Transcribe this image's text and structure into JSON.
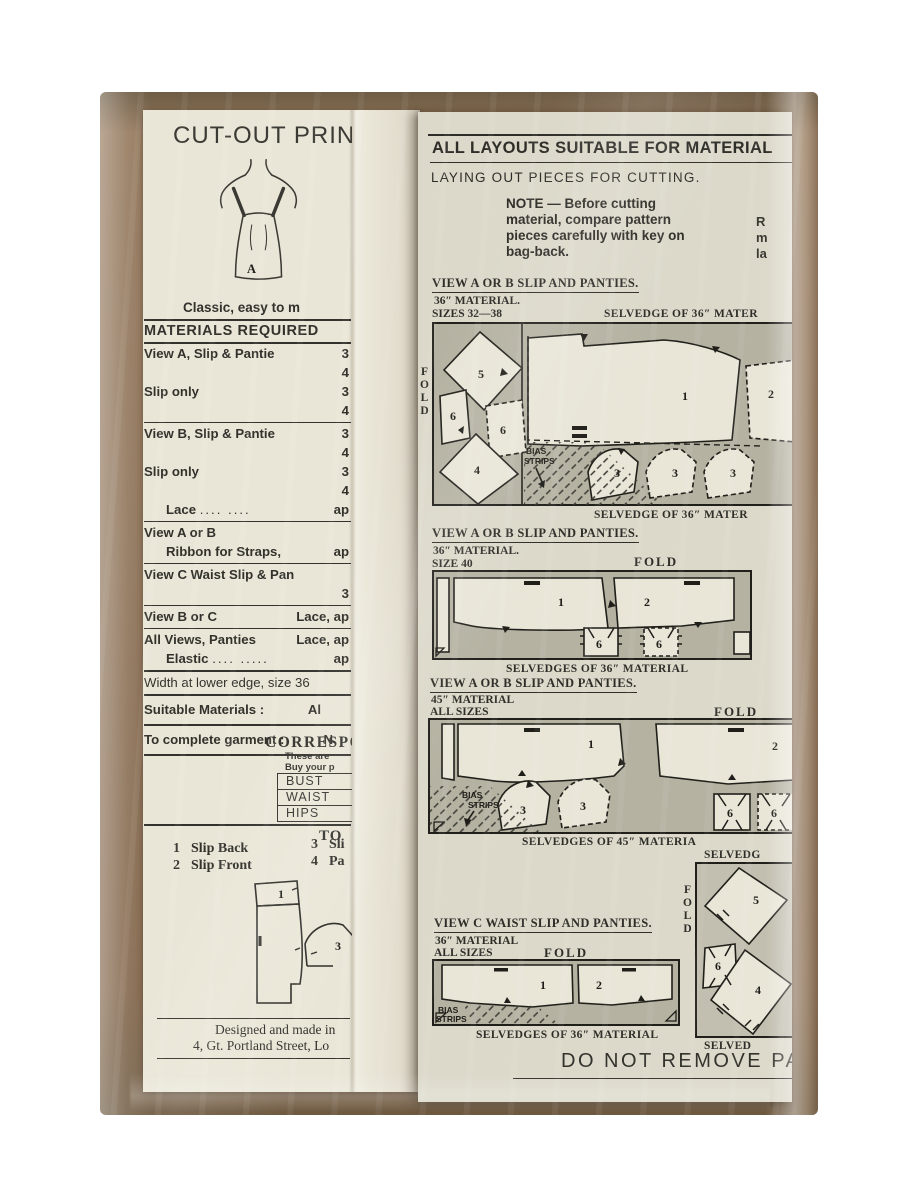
{
  "photo": {
    "background": "#ffffff",
    "kraft_brown": "#8d7257",
    "left_paper": "#eae6d7",
    "right_paper": "#dcd9ca",
    "ink": "#32312c",
    "fabric_gray": "#b5b2a2"
  },
  "left_page": {
    "title": "CUT-OUT PRINTED",
    "figure_label": "A",
    "tagline": "Classic, easy to m",
    "materials": {
      "heading": "MATERIALS REQUIRED",
      "row1": {
        "label": "View A, Slip & Pantie",
        "v": "3"
      },
      "row2": {
        "v": "4"
      },
      "row3": {
        "label": "Slip only",
        "v": "3"
      },
      "row4": {
        "v": "4"
      },
      "row5": {
        "label": "View B, Slip & Pantie",
        "v": "3"
      },
      "row6": {
        "v": "4"
      },
      "row7": {
        "label": "Slip only",
        "v": "3"
      },
      "row8": {
        "v": "4"
      },
      "row9": {
        "label": "Lace",
        "dots": "....        ....",
        "v": "ap"
      },
      "row10": {
        "label": "View A or B"
      },
      "row11": {
        "label": "Ribbon for Straps,",
        "v": "ap"
      },
      "row12": {
        "label": "View C   Waist Slip & Pan",
        "v": "3"
      },
      "row13": {
        "label": "View B or C",
        "v": "Lace, ap"
      },
      "row14": {
        "label": "All Views, Panties",
        "v": "Lace, ap"
      },
      "row15": {
        "label": "Elastic",
        "dots": "....      .....",
        "v": "ap"
      },
      "row16": {
        "label": "Width at lower edge, size 36"
      },
      "row17": {
        "label": "Suitable Materials :",
        "v": "Al"
      },
      "row18": {
        "label": "To complete garment :",
        "v": "N"
      }
    },
    "correspondence": {
      "heading": "CORRESPO",
      "note1": "These are",
      "note2": "Buy your p",
      "measurements": [
        "BUST",
        "WAIST",
        "HIPS"
      ]
    },
    "to_heading": "TO",
    "pieces_list": [
      {
        "num": "1",
        "label": "Slip Back"
      },
      {
        "num": "2",
        "label": "Slip Front"
      },
      {
        "num": "3",
        "label": "Sli"
      },
      {
        "num": "4",
        "label": "Pa"
      }
    ],
    "piece_numbers": {
      "front": "1",
      "small": "3"
    },
    "footer": {
      "line1": "Designed and made in",
      "line2": "4, Gt. Portland Street, Lo"
    }
  },
  "right_page": {
    "header": "ALL LAYOUTS SUITABLE FOR MATERIAL",
    "subheader": "LAYING OUT PIECES FOR CUTTING.",
    "note": "NOTE — Before cutting material, compare pattern pieces carefully with key on bag-back.",
    "edge_fragment": {
      "l1": "R",
      "l2": "m",
      "l3": "la"
    },
    "fold": "FOLD",
    "bias": {
      "line1": "BIAS",
      "line2": "STRIPS"
    },
    "layout1": {
      "caption": "VIEW A OR B SLIP AND PANTIES.",
      "material": "36″ MATERIAL.",
      "sizes": "SIZES 32—38",
      "selvedge_top": "SELVEDGE OF 36″ MATER",
      "selvedge_bottom": "SELVEDGE OF 36″ MATER",
      "pieces": [
        "5",
        "6",
        "6",
        "4",
        "1",
        "2",
        "3",
        "3",
        "3"
      ]
    },
    "layout2": {
      "caption": "VIEW A OR B SLIP AND PANTIES.",
      "material": "36″ MATERIAL.",
      "sizes": "SIZE 40",
      "selvedge_bottom": "SELVEDGES OF 36″ MATERIAL",
      "pieces": [
        "1",
        "2",
        "6",
        "6"
      ]
    },
    "layout3": {
      "caption": "VIEW A OR B SLIP AND PANTIES.",
      "material": "45″ MATERIAL",
      "sizes": "ALL SIZES",
      "selvedge_bottom": "SELVEDGES OF 45″ MATERIA",
      "pieces": [
        "1",
        "2",
        "3",
        "3",
        "6",
        "6"
      ]
    },
    "side_column": {
      "selvedge_top": "SELVEDG",
      "selvedge_bottom": "SELVED",
      "pieces": [
        "5",
        "6",
        "4"
      ]
    },
    "layout4": {
      "caption": "VIEW C    WAIST SLIP AND PANTIES.",
      "material": "36″ MATERIAL",
      "sizes": "ALL SIZES",
      "selvedge_bottom": "SELVEDGES OF 36″ MATERIAL",
      "pieces": [
        "1",
        "2"
      ]
    },
    "warning": "DO NOT REMOVE PATTE"
  }
}
